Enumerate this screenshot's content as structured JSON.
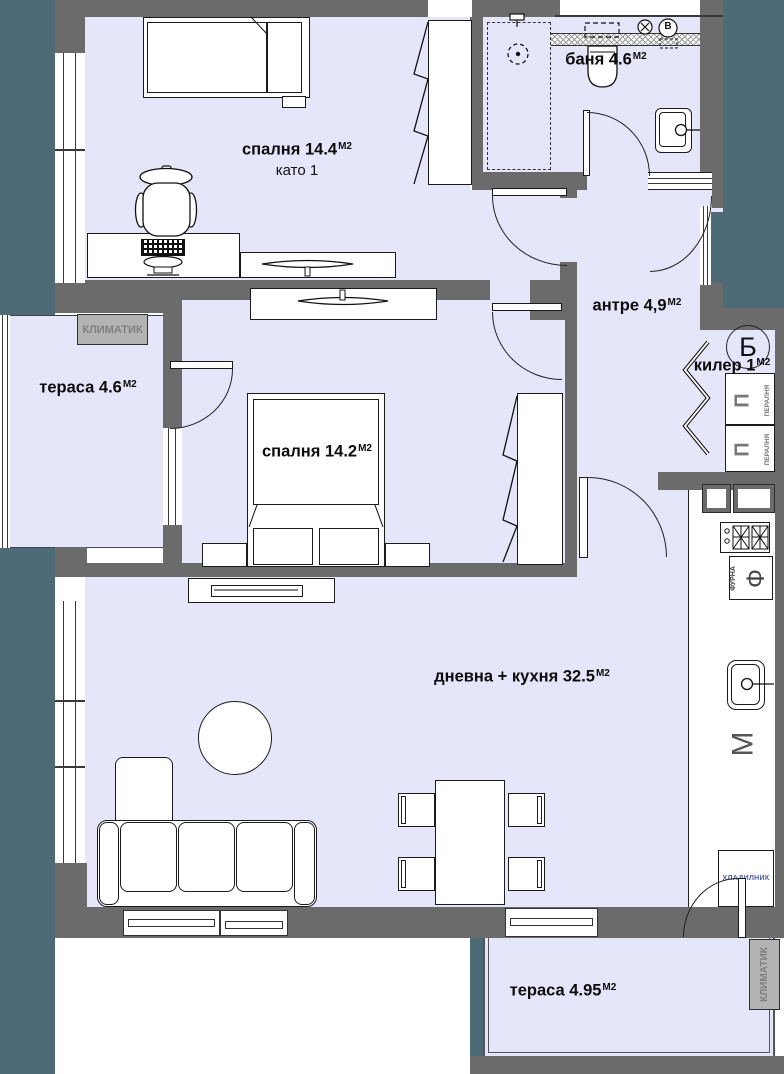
{
  "plan": {
    "rooms": [
      {
        "id": "bedroom-1",
        "label": "спалня 14.4",
        "sup": "М2",
        "note": "като 1"
      },
      {
        "id": "bathroom",
        "label": "баня 4.6",
        "sup": "М2"
      },
      {
        "id": "hallway",
        "label": "антре 4,9",
        "sup": "М2"
      },
      {
        "id": "closet",
        "label": "килер 1",
        "sup": "М2"
      },
      {
        "id": "terrace-left",
        "label": "тераса 4.6",
        "sup": "М2"
      },
      {
        "id": "bedroom-2",
        "label": "спалня 14.2",
        "sup": "М2"
      },
      {
        "id": "living-kitchen",
        "label": "дневна + кухня 32.5",
        "sup": "М2"
      },
      {
        "id": "terrace-bottom",
        "label": "тераса 4.95",
        "sup": "М2"
      }
    ],
    "markers": {
      "section": "Б",
      "ac": "КЛИМАТИК",
      "washer": "ПЕРАЛНЯ",
      "washer_symbol": "П",
      "oven_text": "ФУРНА",
      "oven_symbol": "Ф",
      "appliance_m": "М",
      "fridge": "ХЛАДИЛНИК",
      "vent": "В"
    },
    "colors": {
      "outside": "#4d6b76",
      "wall": "#6b6b6b",
      "floor": "#e6e6fa",
      "line": "#1c1c1c",
      "ac_box": "#b3b3b3"
    }
  }
}
